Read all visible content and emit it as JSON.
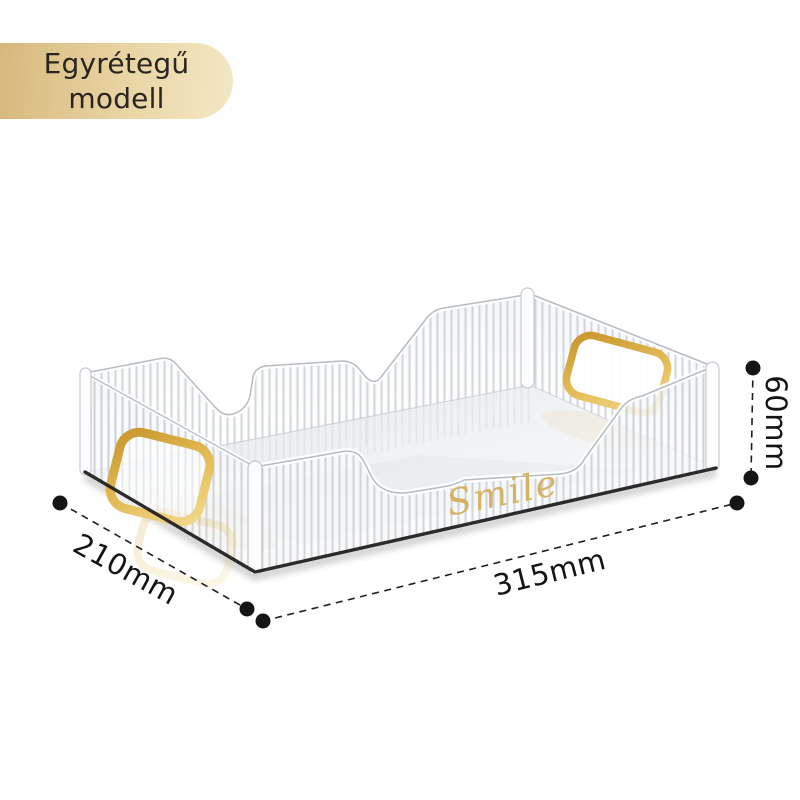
{
  "badge": {
    "line1": "Egyrétegű",
    "line2": "modell"
  },
  "product": {
    "description": "transparent ribbed acrylic storage tray with gold handles",
    "engraving": "Smile"
  },
  "dims": {
    "depth": {
      "label": "210mm"
    },
    "width": {
      "label": "315mm"
    },
    "height": {
      "label": "60mm"
    }
  },
  "colors": {
    "badge_gold_left": "#d7b87c",
    "badge_gold_right": "#f4e8c6",
    "handle_gold": "#d9a83c",
    "engraving_gold": "#d6b263",
    "dimension_line": "#1f1f1f"
  }
}
